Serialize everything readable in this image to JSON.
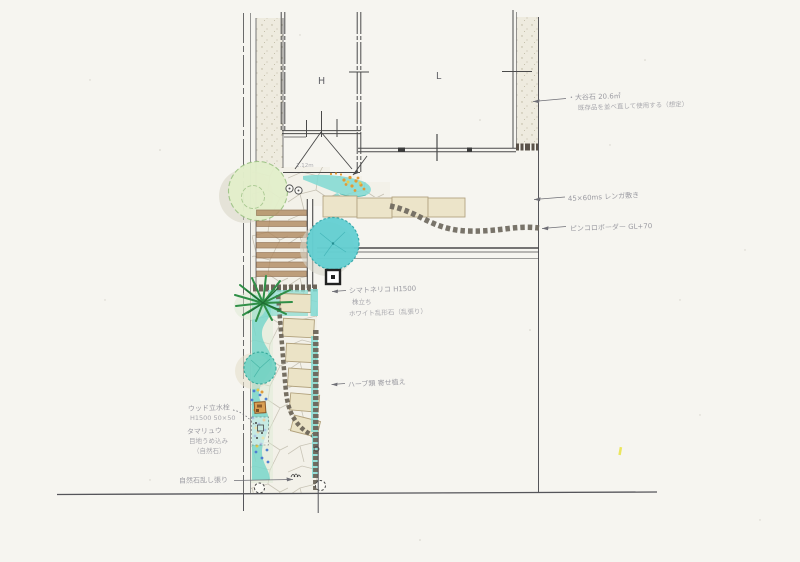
{
  "plan": {
    "room_labels": {
      "h": "H",
      "l": "L"
    },
    "porch_note": "1.12m",
    "notes": {
      "oya_stone": {
        "l1": "・大谷石 20.6㎡",
        "l2": "既存品を並べ直して使用する（想定）"
      },
      "brick_path": "45×60ms レンガ敷き",
      "pinkoro": "ピンコロボーダー GL+70",
      "symbol_tree": {
        "l1": "シマトネリコ H1500",
        "l2": "株立ち",
        "l3": "ホワイト乱形石（乱張り）"
      },
      "herbs": "ハーブ類 寄せ植え",
      "wood_tap": {
        "l1": "ウッド立水栓",
        "l2": "H1500 50×50"
      },
      "ground_cover": {
        "l1": "タマリュウ",
        "l2": "目地うめ込み",
        "l3": "（自然石）"
      },
      "flagstone": "自然石乱し張り"
    },
    "colors": {
      "paper": "#f6f5f0",
      "pencil": "#4a4a4a",
      "note_ink": "#8b8b94",
      "teal_shrub": "#5fcfd2",
      "leaf_green": "#e3efcb",
      "dark_green": "#2f8f47",
      "stone_beige": "#ece4c9",
      "step_brown": "#b28c63",
      "flower_orange": "#e39a35",
      "flower_blue": "#4f7fd0",
      "flower_yellow": "#e6cc52"
    }
  }
}
